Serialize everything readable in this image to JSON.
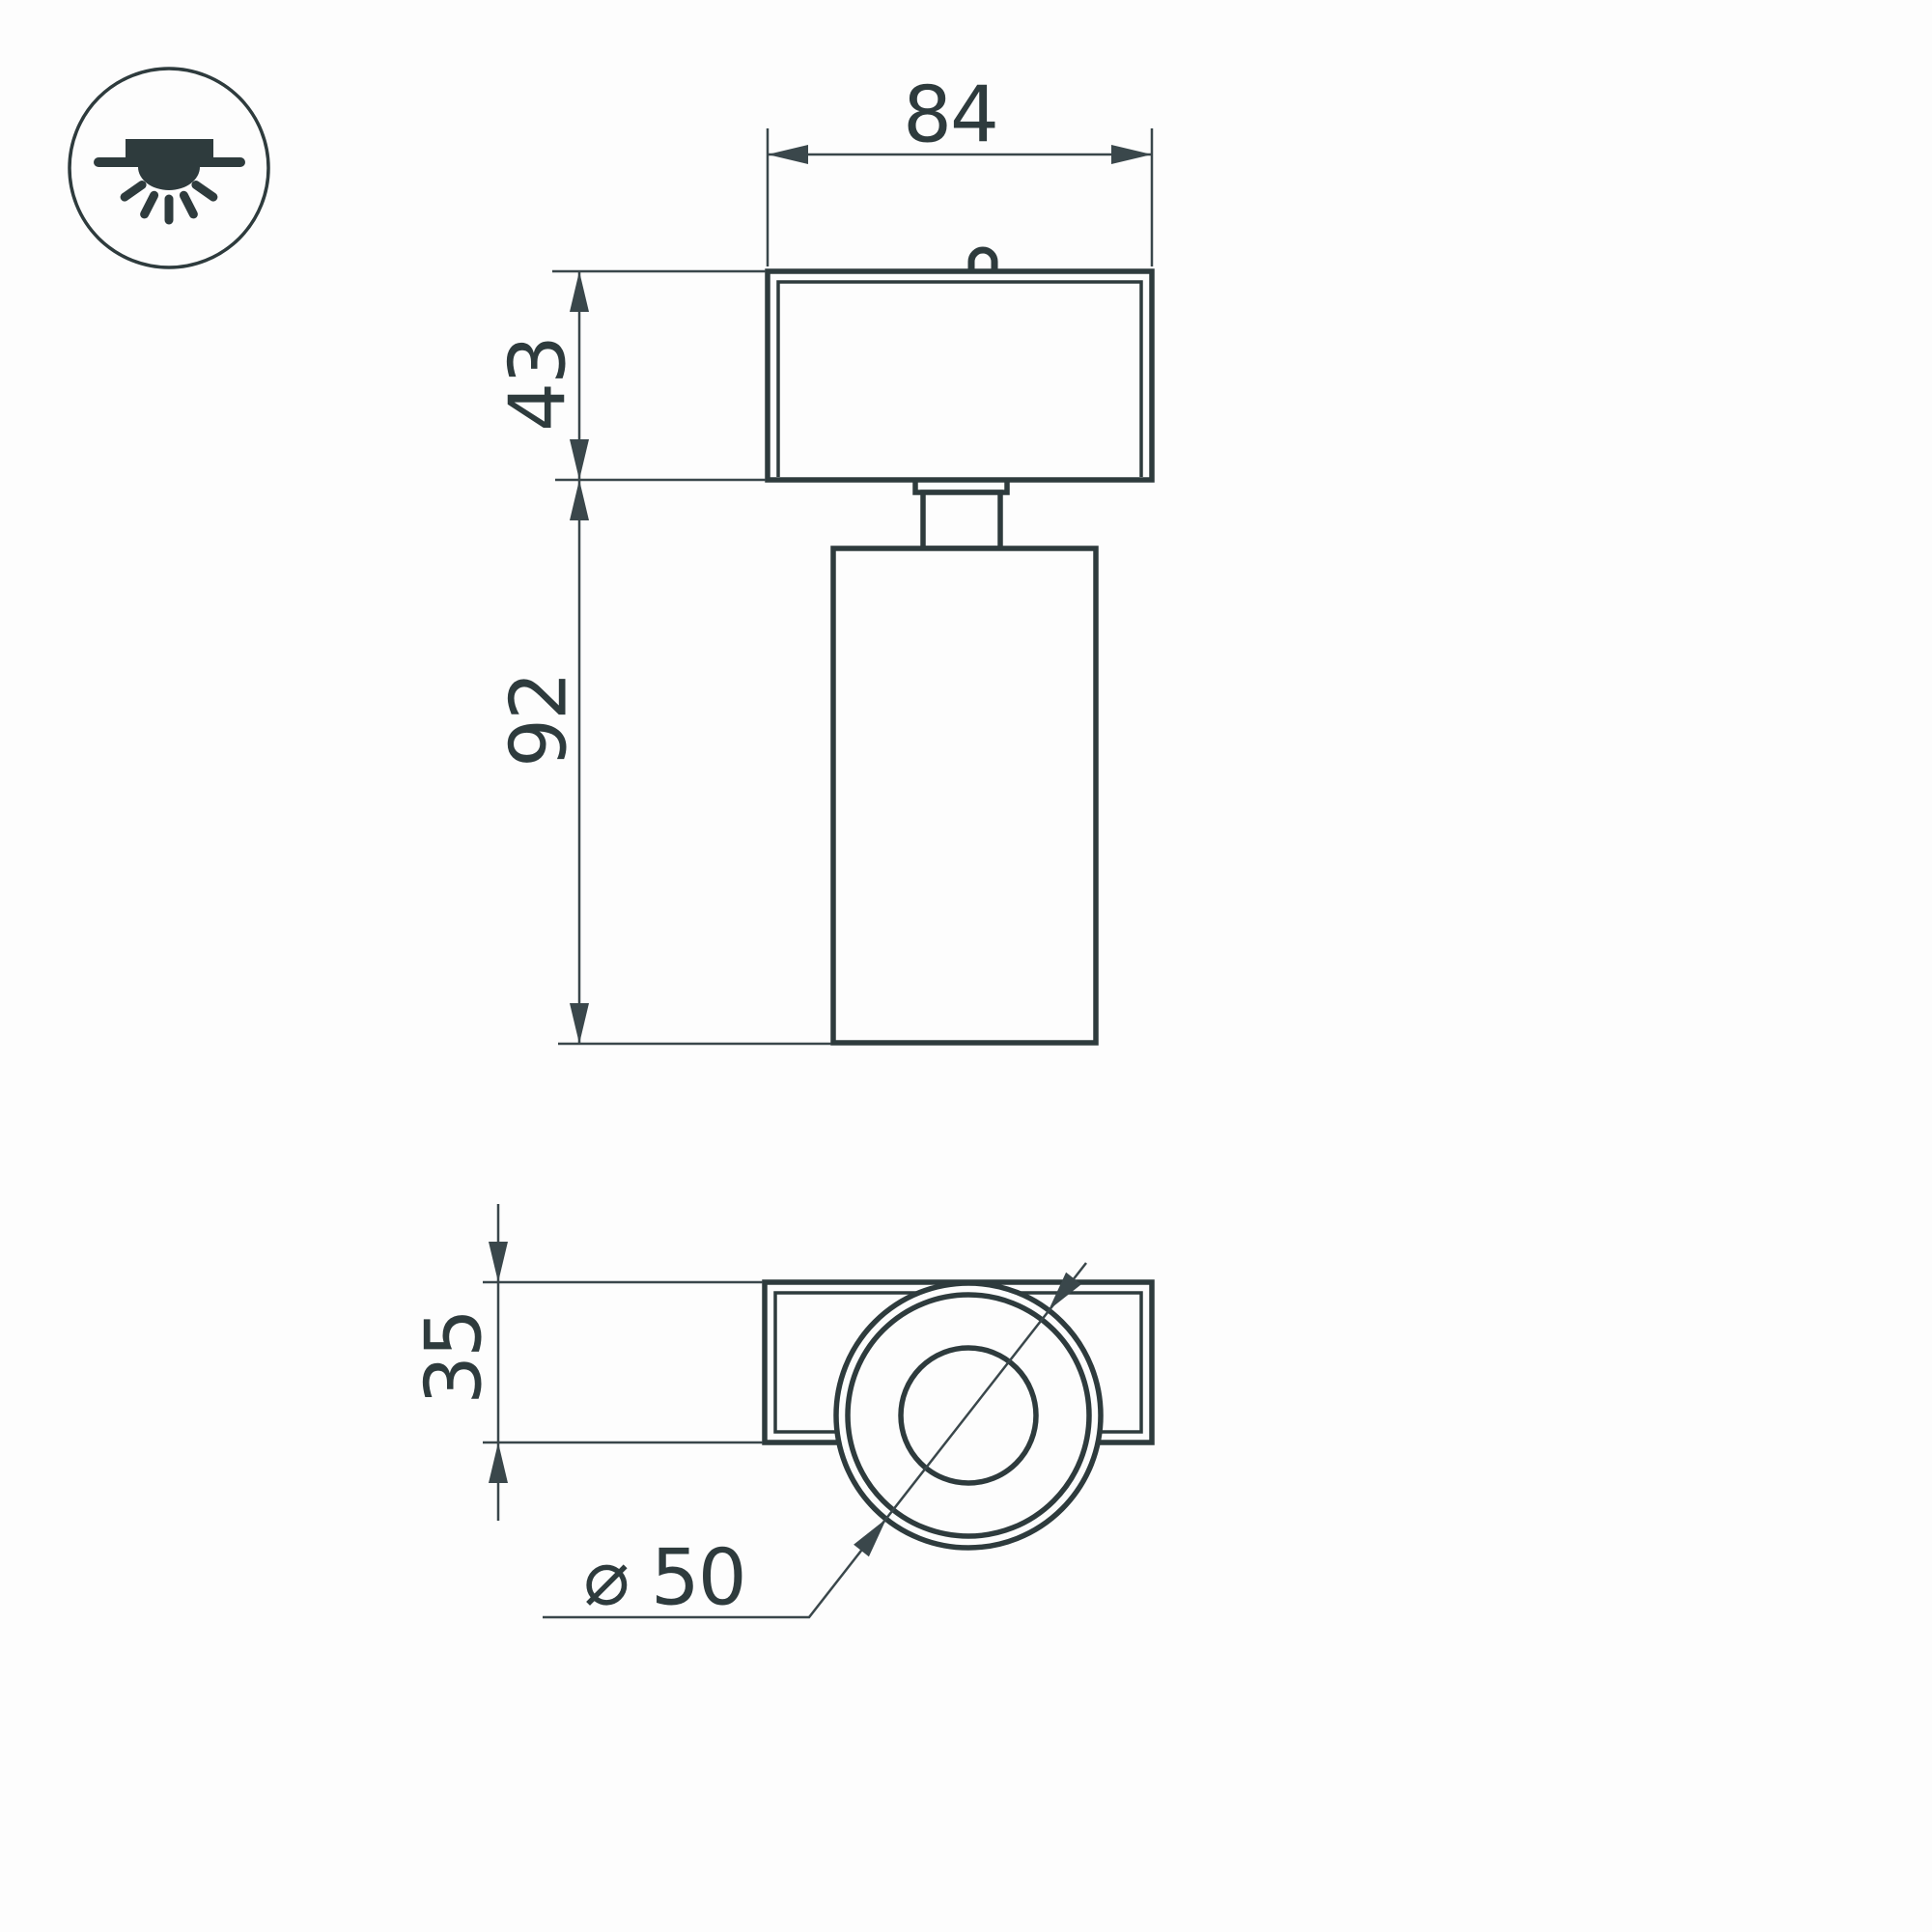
{
  "drawing": {
    "kind": "luminaire-dimension-drawing",
    "background": "#fdfdfd",
    "stroke_color": "#2e3b3d",
    "dim_color": "#3a474b"
  },
  "icon": {
    "name": "surface-mounted-downlight-icon"
  },
  "labels": {
    "width": "84",
    "cap_height": "43",
    "body_height": "92",
    "depth": "35",
    "diameter": "⌀ 50"
  }
}
